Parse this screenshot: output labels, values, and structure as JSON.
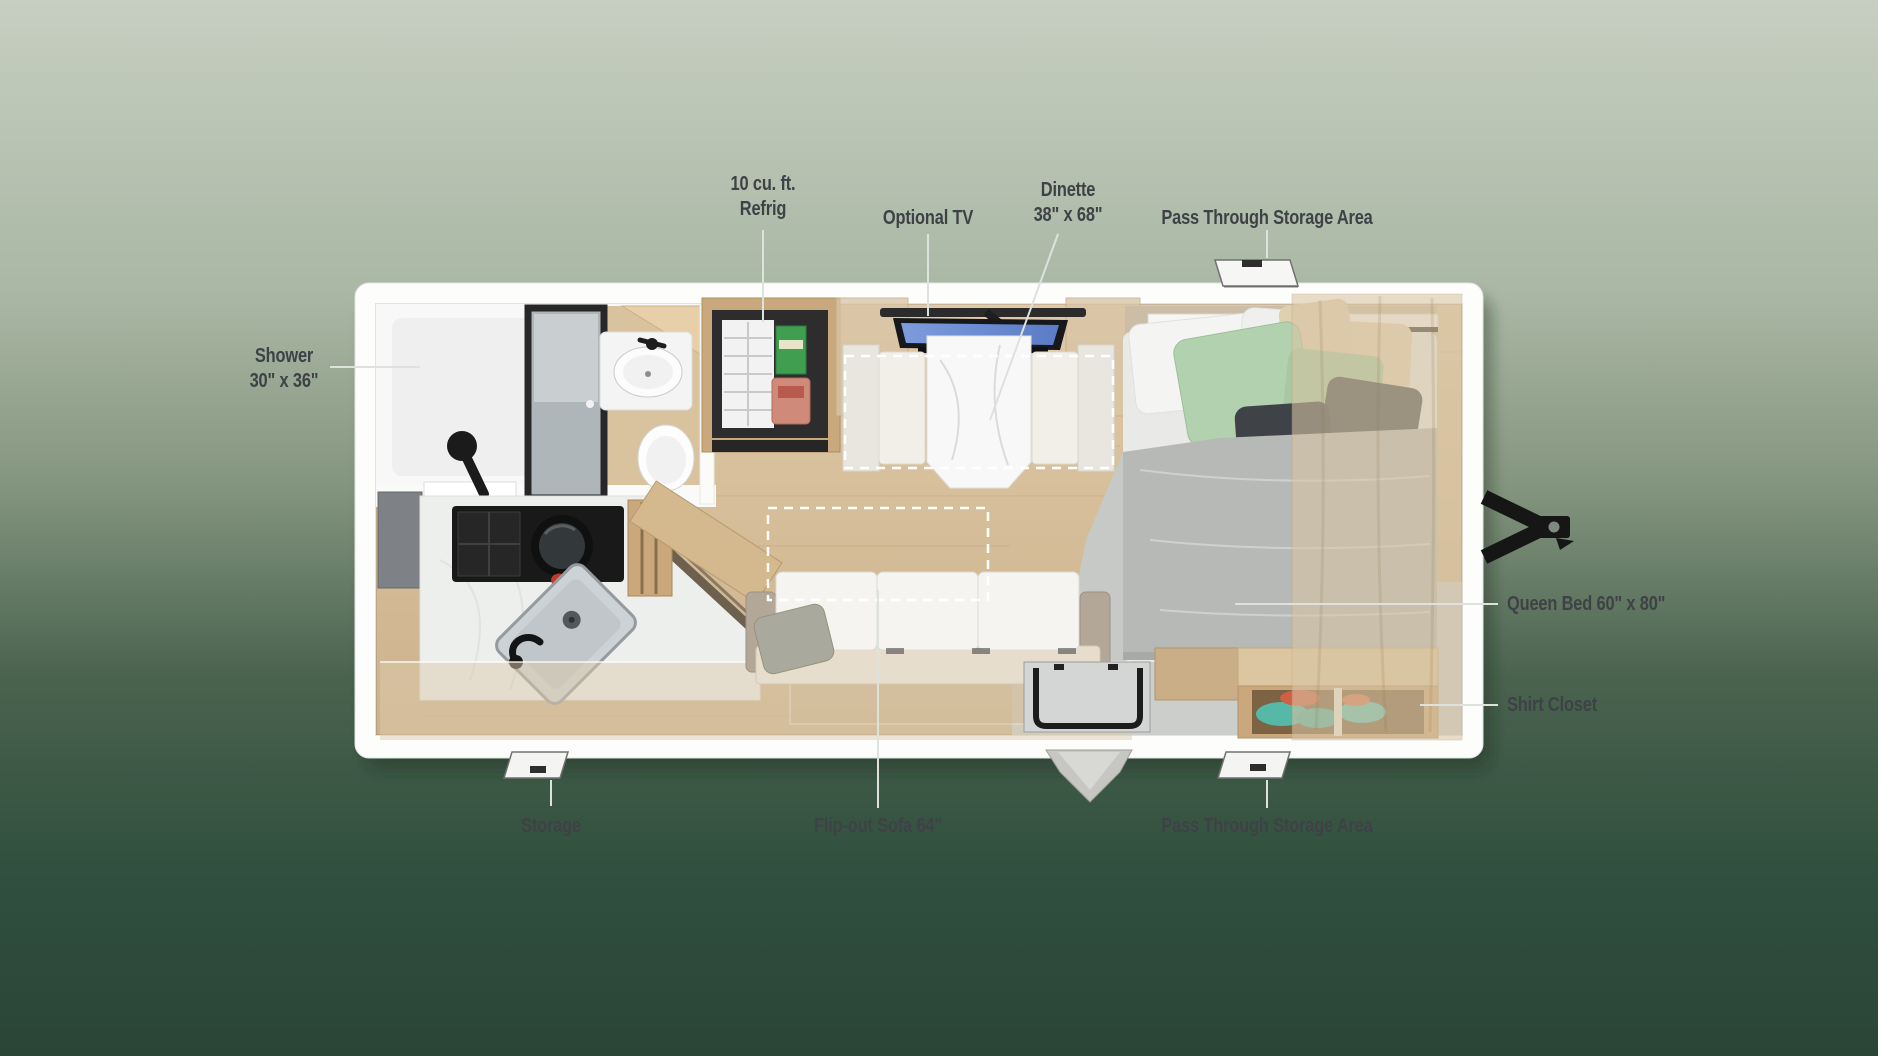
{
  "labels": {
    "refrig": {
      "line1": "10 cu. ft.",
      "line2": "Refrig"
    },
    "optional_tv": {
      "text": "Optional TV"
    },
    "dinette": {
      "line1": "Dinette",
      "line2": "38\" x 68\""
    },
    "pass_through_top": {
      "text": "Pass Through Storage Area"
    },
    "shower": {
      "line1": "Shower",
      "line2": "30\" x 36\""
    },
    "queen_bed": {
      "text": "Queen Bed 60\" x 80\""
    },
    "shirt_closet": {
      "text": "Shirt Closet"
    },
    "storage": {
      "text": "Storage"
    },
    "flip_out_sofa": {
      "text": "Flip-out Sofa 64\""
    },
    "pass_through_bottom": {
      "text": "Pass Through Storage Area"
    }
  },
  "fixtures": [
    "shower-icon",
    "bath-sink-icon",
    "toilet-icon",
    "refrigerator-icon",
    "tv-icon",
    "dinette-table-icon",
    "overhead-cabinet-icon",
    "queen-bed-icon",
    "pillows-icon",
    "shirt-closet-icon",
    "stove-icon",
    "kitchen-sink-icon",
    "flip-out-sofa-icon",
    "entry-door-icon",
    "entry-step-icon",
    "storage-hatch-icon",
    "pass-through-hatch-icon",
    "trailer-hitch-icon"
  ],
  "colors": {
    "background_top": "#c6cfc1",
    "background_bottom": "#2a4536",
    "label_text": "#3e4246",
    "shell_white": "#fdfdfc",
    "floor_wood": "#d6bf9d",
    "cabinet_wood": "#c9ad85",
    "counter_white": "#eef0ee",
    "tv_screen": "#6a8fd8",
    "comforter_gray": "#b6b9b6",
    "pillow_green": "#b2d2af",
    "closet_teal": "#56b8a6",
    "stove_black": "#1c1c1c",
    "hitch_black": "#161616"
  }
}
